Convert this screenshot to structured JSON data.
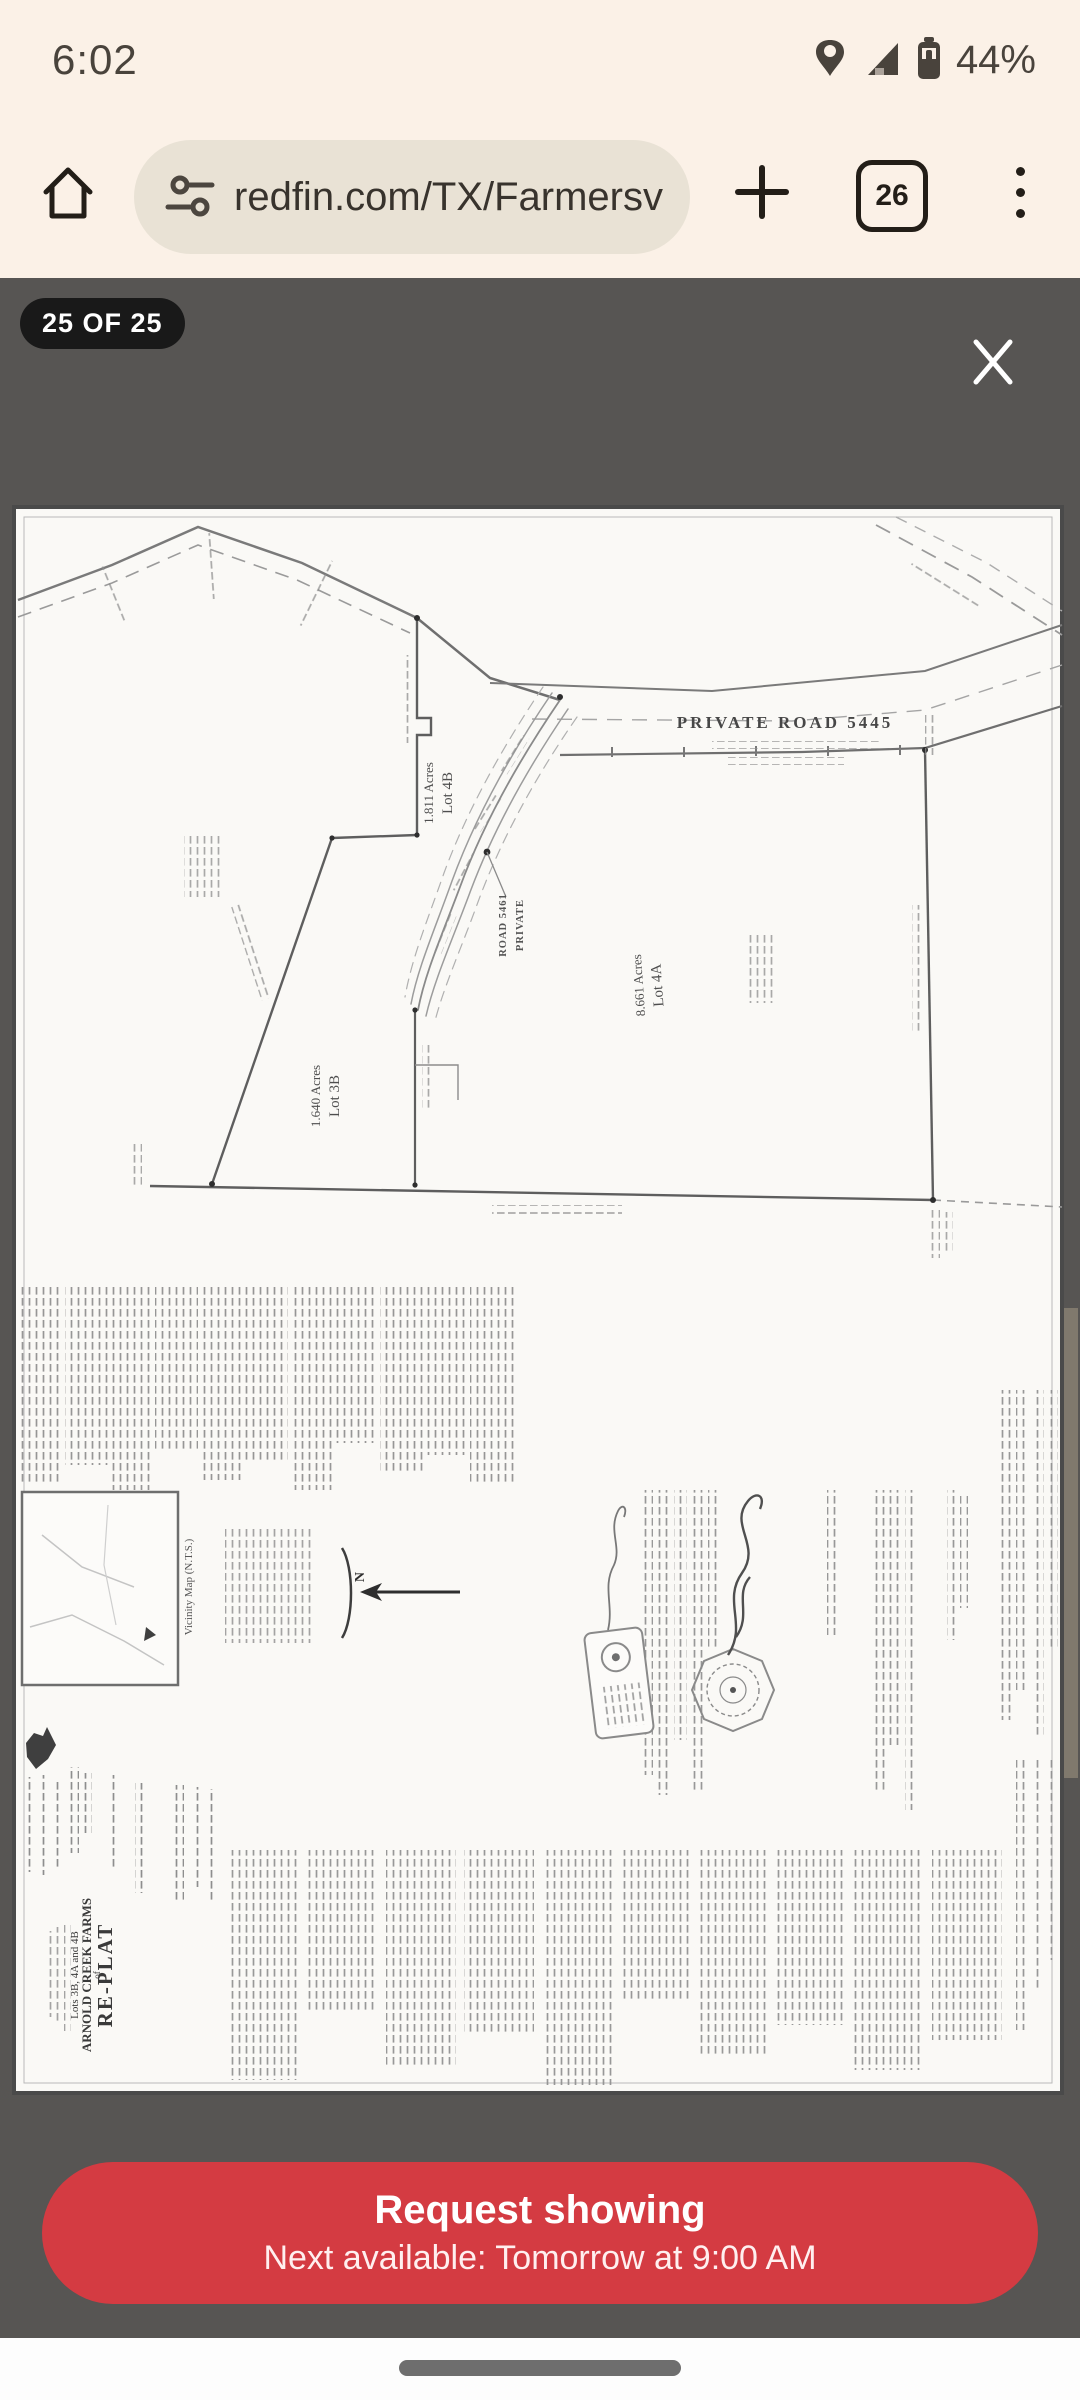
{
  "status_bar": {
    "time": "6:02",
    "battery": "44%"
  },
  "browser": {
    "url": "redfin.com/TX/Farmersv",
    "tab_count": "26"
  },
  "viewer": {
    "counter": "25 OF 25"
  },
  "plat": {
    "road_top": "PRIVATE ROAD 5445",
    "road_mid_line1": "PRIVATE",
    "road_mid_line2": "ROAD 5461",
    "lots": [
      {
        "name": "Lot 4B",
        "acres": "1.811 Acres"
      },
      {
        "name": "Lot 4A",
        "acres": "8.661 Acres"
      },
      {
        "name": "Lot 3B",
        "acres": "1.640 Acres"
      }
    ],
    "vicinity_label": "Vicinity Map (N.T.S.)",
    "north_label": "N",
    "title_block": {
      "line1": "RE-PLAT",
      "line2": "of",
      "line3": "ARNOLD CREEK FARMS",
      "line4": "Lots 3B, 4A and 4B"
    }
  },
  "cta": {
    "title": "Request showing",
    "subtitle": "Next available: Tomorrow at 9:00 AM"
  }
}
